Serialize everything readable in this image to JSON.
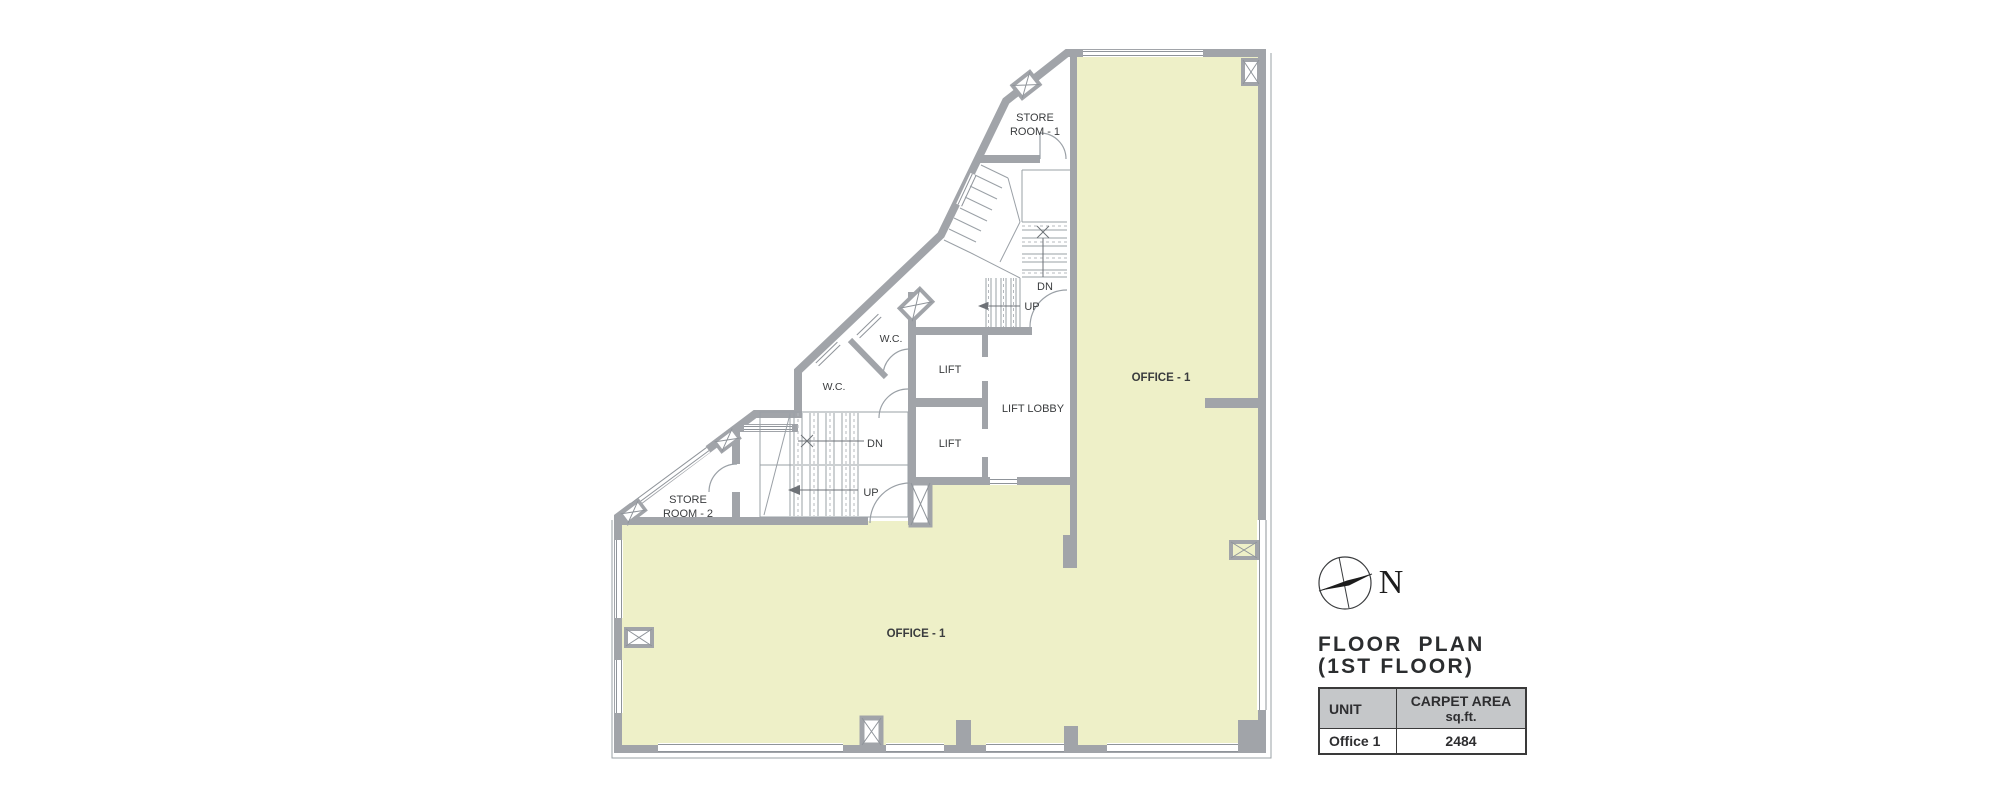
{
  "colors": {
    "wall": "#a1a4a9",
    "office_fill": "#eef0c8",
    "thin_line": "#9aa0a6",
    "dashed_line": "#b4b8bd",
    "text": "#3a3c3e",
    "table_header_bg": "#c5c7c9",
    "table_border": "#3a3a3a"
  },
  "plan": {
    "rooms": {
      "office_right": "OFFICE - 1",
      "office_bottom": "OFFICE - 1",
      "store_room_1_line1": "STORE",
      "store_room_1_line2": "ROOM - 1",
      "store_room_2_line1": "STORE",
      "store_room_2_line2": "ROOM - 2",
      "wc_upper": "W.C.",
      "wc_lower": "W.C.",
      "lift_upper": "LIFT",
      "lift_lower": "LIFT",
      "lift_lobby": "LIFT LOBBY"
    },
    "stairs": {
      "dn_upper": "DN",
      "up_upper": "UP",
      "dn_lower": "DN",
      "up_lower": "UP"
    }
  },
  "compass": {
    "north_label": "N"
  },
  "legend": {
    "title_line1": "FLOOR  PLAN",
    "title_line2": "(1ST FLOOR)"
  },
  "table": {
    "headers": {
      "unit": "UNIT",
      "carpet_area_line1": "CARPET AREA",
      "carpet_area_line2": "sq.ft."
    },
    "rows": [
      {
        "unit": "Office 1",
        "carpet_area": "2484"
      }
    ]
  }
}
